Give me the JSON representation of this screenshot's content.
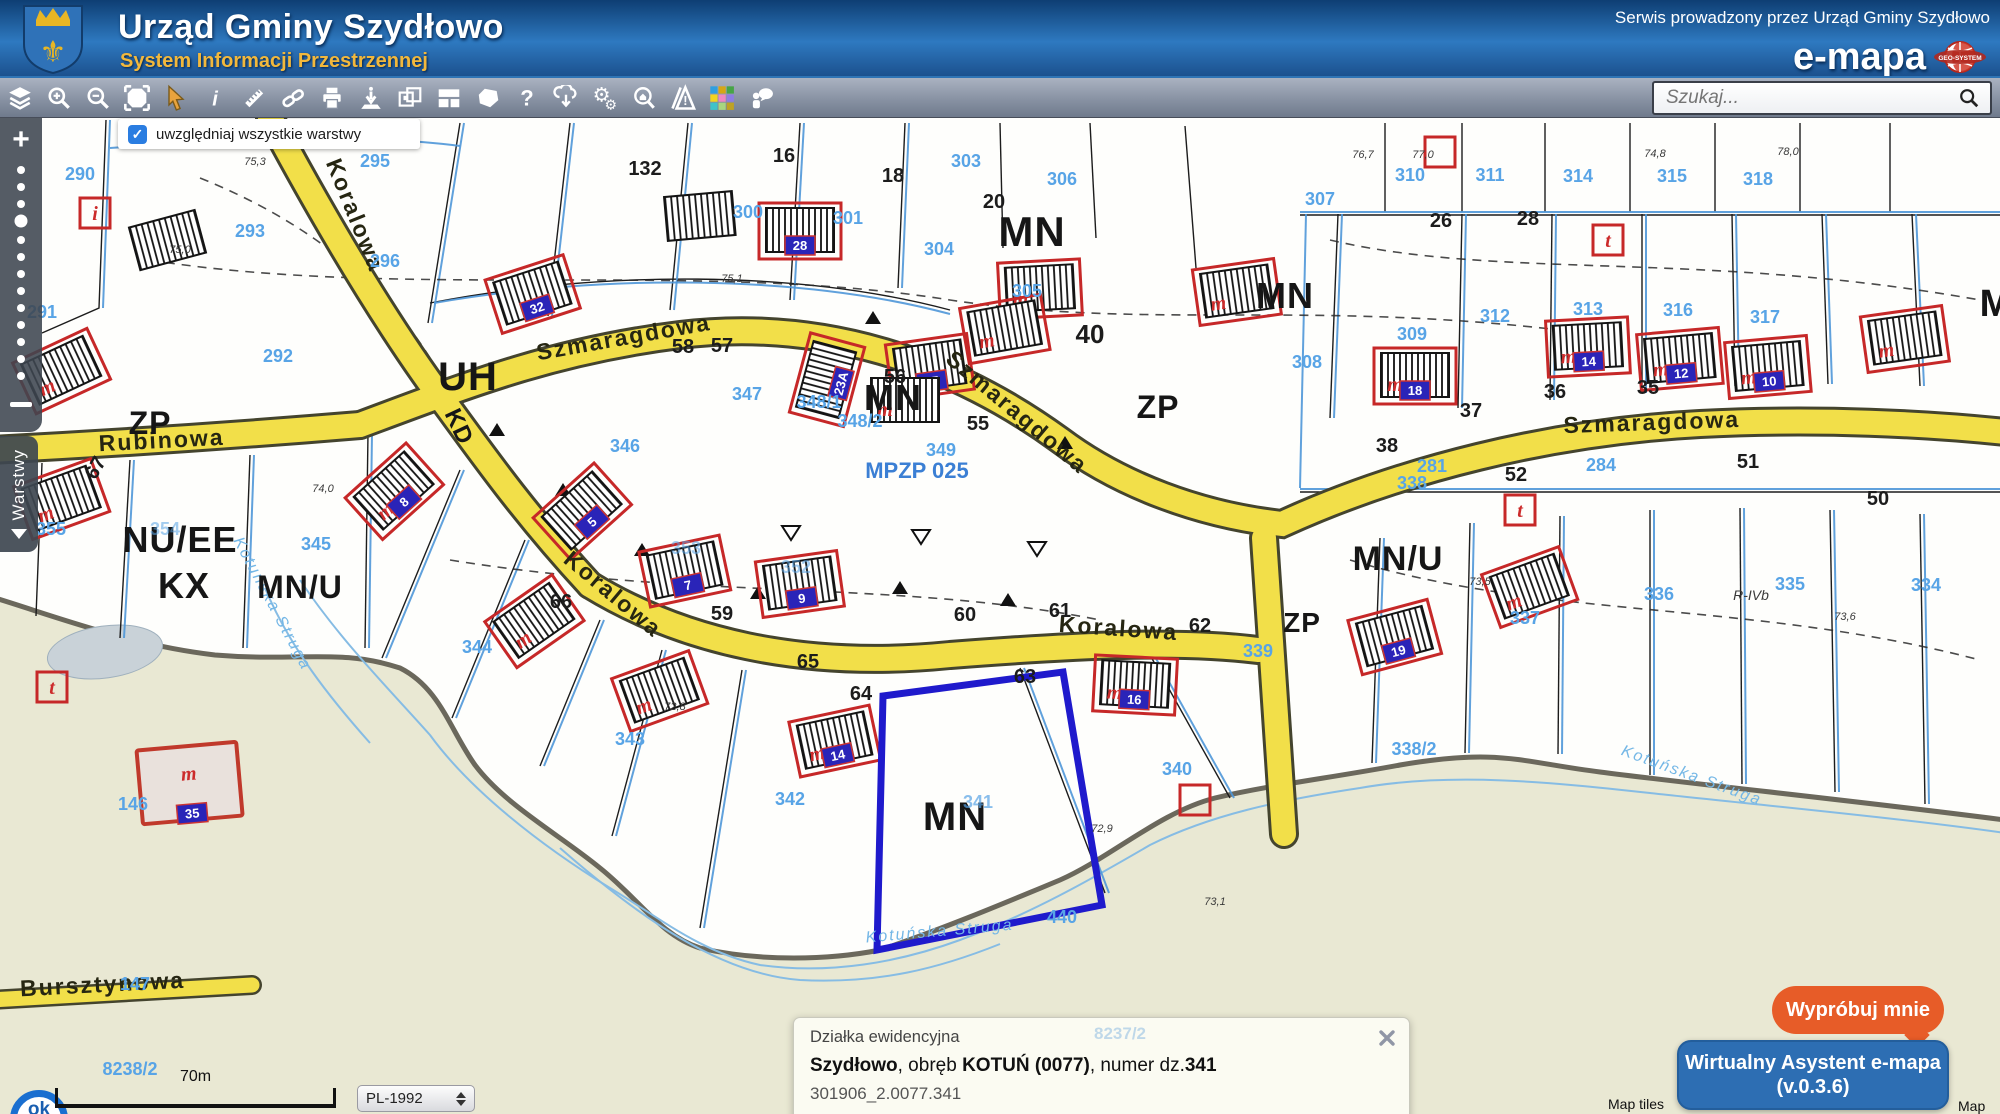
{
  "header": {
    "title": "Urząd Gminy Szydłowo",
    "subtitle": "System Informacji Przestrzennej",
    "service_note": "Serwis prowadzony przez Urząd Gminy Szydłowo",
    "brand": "e-mapa",
    "brand_logo_text": "GEO-SYSTEM"
  },
  "toolbar": {
    "search_placeholder": "Szukaj...",
    "tools": [
      "layers",
      "zoom-in",
      "zoom-out",
      "full-extent",
      "pointer",
      "info",
      "measure",
      "link",
      "print",
      "locate",
      "compare",
      "layout",
      "polygon",
      "help",
      "download",
      "settings",
      "search-address",
      "warnings",
      "basemaps",
      "feedback"
    ]
  },
  "map_controls": {
    "layers_checkbox_label": "uwzględniaj wszystkie warstwy",
    "checkbox_checked": "✓",
    "zoom_in": "+",
    "layers_tab": "Warstwy"
  },
  "bottom_bar": {
    "scale": "70m",
    "crs": "PL-1992",
    "logo": "ok",
    "attribution_left": "Map tiles",
    "attribution_right": "Map"
  },
  "info_panel": {
    "title": "Działka ewidencyjna",
    "ghost": "8237/2",
    "b1": "Szydłowo",
    "t1": ", obręb ",
    "b2": "KOTUŃ (0077)",
    "t2": ", numer dz.",
    "b3": "341",
    "parcel_id": "301906_2.0077.341",
    "link1": "Zbliż do obiektu",
    "link2": "Szczegóły (I)",
    "geo_icon": "i",
    "link3": "Informacja o lokalizacji"
  },
  "assistant": {
    "try_label": "Wypróbuj mnie",
    "name": "Wirtualny Asystent e-mapa",
    "version": "(v.0.3.6)"
  },
  "map": {
    "selected_parcel": "341",
    "accent_colors": {
      "road": "#f2df49",
      "parcel_line": "#4f97d8",
      "selected": "#1f1acc",
      "building": "#c62828",
      "label": "#58a4e6"
    },
    "labels": [
      {
        "t": "Szmaragdowa",
        "k": "street",
        "x": 625,
        "y": 227,
        "r": -10
      },
      {
        "t": "Szmaragdowa",
        "k": "street",
        "x": 1012,
        "y": 300,
        "r": 40
      },
      {
        "t": "Szmaragdowa",
        "k": "street",
        "x": 1652,
        "y": 312,
        "r": -2
      },
      {
        "t": "Rubinowa",
        "k": "street",
        "x": 162,
        "y": 330,
        "r": -3
      },
      {
        "t": "Koralowa",
        "k": "street",
        "x": 348,
        "y": 100,
        "r": 68
      },
      {
        "t": "Koralowa",
        "k": "street",
        "x": 608,
        "y": 482,
        "r": 40
      },
      {
        "t": "Koralowa",
        "k": "street",
        "x": 1118,
        "y": 518,
        "r": 4
      },
      {
        "t": "Bursztynowa",
        "k": "street",
        "x": 103,
        "y": 874,
        "r": -3
      },
      {
        "t": "Kotuńska Struga",
        "k": "stream",
        "x": 268,
        "y": 488,
        "r": 62
      },
      {
        "t": "Kotuńska Struga",
        "k": "stream",
        "x": 940,
        "y": 818,
        "r": -5
      },
      {
        "t": "Kotuńska Struga",
        "k": "stream",
        "x": 1690,
        "y": 662,
        "r": 20
      },
      {
        "t": "MPZP 025",
        "k": "plan",
        "x": 917,
        "y": 360
      },
      {
        "t": "MN",
        "k": "zone",
        "x": 1032,
        "y": 128,
        "s": 42
      },
      {
        "t": "MN",
        "k": "zone",
        "x": 893,
        "y": 292,
        "s": 36
      },
      {
        "t": "MN",
        "k": "zone",
        "x": 955,
        "y": 712,
        "s": 40
      },
      {
        "t": "MN",
        "k": "zone",
        "x": 1285,
        "y": 190,
        "s": 36
      },
      {
        "t": "M",
        "k": "zone",
        "x": 1996,
        "y": 198,
        "s": 38
      },
      {
        "t": "MN/U",
        "k": "zone",
        "x": 300,
        "y": 480,
        "s": 32
      },
      {
        "t": "MN/U",
        "k": "zone",
        "x": 1398,
        "y": 452,
        "s": 34
      },
      {
        "t": "ZP",
        "k": "zone",
        "x": 150,
        "y": 316,
        "s": 32
      },
      {
        "t": "ZP",
        "k": "zone",
        "x": 1158,
        "y": 300,
        "s": 32
      },
      {
        "t": "ZP",
        "k": "zone",
        "x": 1302,
        "y": 514,
        "s": 28
      },
      {
        "t": "NU/EE",
        "k": "zone",
        "x": 180,
        "y": 434,
        "s": 36
      },
      {
        "t": "KX",
        "k": "zone",
        "x": 184,
        "y": 480,
        "s": 36
      },
      {
        "t": "UH",
        "k": "zone",
        "x": 468,
        "y": 272,
        "s": 40
      },
      {
        "t": "KD",
        "k": "zone",
        "x": 452,
        "y": 312,
        "s": 24,
        "r": 65
      },
      {
        "t": "290",
        "k": "pn",
        "x": 80,
        "y": 62
      },
      {
        "t": "291",
        "k": "pn",
        "x": 42,
        "y": 200
      },
      {
        "t": "292",
        "k": "pn",
        "x": 278,
        "y": 244
      },
      {
        "t": "293",
        "k": "pn",
        "x": 250,
        "y": 119
      },
      {
        "t": "295",
        "k": "pn",
        "x": 375,
        "y": 49
      },
      {
        "t": "296",
        "k": "pn",
        "x": 385,
        "y": 149
      },
      {
        "t": "300",
        "k": "pn",
        "x": 748,
        "y": 100
      },
      {
        "t": "301",
        "k": "pn",
        "x": 848,
        "y": 106
      },
      {
        "t": "303",
        "k": "pn",
        "x": 966,
        "y": 49
      },
      {
        "t": "304",
        "k": "pn",
        "x": 939,
        "y": 137
      },
      {
        "t": "305",
        "k": "pn",
        "x": 1027,
        "y": 179
      },
      {
        "t": "306",
        "k": "pn",
        "x": 1062,
        "y": 67
      },
      {
        "t": "307",
        "k": "pn",
        "x": 1320,
        "y": 87
      },
      {
        "t": "308",
        "k": "pn",
        "x": 1307,
        "y": 250
      },
      {
        "t": "309",
        "k": "pn",
        "x": 1412,
        "y": 222
      },
      {
        "t": "310",
        "k": "pn",
        "x": 1410,
        "y": 63
      },
      {
        "t": "311",
        "k": "pn",
        "x": 1490,
        "y": 63
      },
      {
        "t": "312",
        "k": "pn",
        "x": 1495,
        "y": 204
      },
      {
        "t": "313",
        "k": "pn",
        "x": 1588,
        "y": 197
      },
      {
        "t": "314",
        "k": "pn",
        "x": 1578,
        "y": 64
      },
      {
        "t": "315",
        "k": "pn",
        "x": 1672,
        "y": 64
      },
      {
        "t": "316",
        "k": "pn",
        "x": 1678,
        "y": 198
      },
      {
        "t": "317",
        "k": "pn",
        "x": 1765,
        "y": 205
      },
      {
        "t": "318",
        "k": "pn",
        "x": 1758,
        "y": 67
      },
      {
        "t": "281",
        "k": "pn",
        "x": 1432,
        "y": 354
      },
      {
        "t": "284",
        "k": "pn",
        "x": 1601,
        "y": 353
      },
      {
        "t": "355",
        "k": "pn",
        "x": 51,
        "y": 417
      },
      {
        "t": "354",
        "k": "pn",
        "x": 165,
        "y": 417,
        "o": 0.55
      },
      {
        "t": "345",
        "k": "pn",
        "x": 316,
        "y": 432
      },
      {
        "t": "344",
        "k": "pn",
        "x": 477,
        "y": 535
      },
      {
        "t": "346",
        "k": "pn",
        "x": 625,
        "y": 334
      },
      {
        "t": "347",
        "k": "pn",
        "x": 747,
        "y": 282
      },
      {
        "t": "348/1",
        "k": "pn",
        "x": 819,
        "y": 290
      },
      {
        "t": "348/2",
        "k": "pn",
        "x": 860,
        "y": 309
      },
      {
        "t": "349",
        "k": "pn",
        "x": 941,
        "y": 338
      },
      {
        "t": "353",
        "k": "pn",
        "x": 686,
        "y": 436,
        "o": 0.55
      },
      {
        "t": "352",
        "k": "pn",
        "x": 796,
        "y": 455,
        "o": 0.55
      },
      {
        "t": "339",
        "k": "pn",
        "x": 1258,
        "y": 539
      },
      {
        "t": "340",
        "k": "pn",
        "x": 1177,
        "y": 657
      },
      {
        "t": "341",
        "k": "pn",
        "x": 978,
        "y": 690,
        "o": 0.7
      },
      {
        "t": "342",
        "k": "pn",
        "x": 790,
        "y": 687
      },
      {
        "t": "343",
        "k": "pn",
        "x": 630,
        "y": 627
      },
      {
        "t": "440",
        "k": "pn",
        "x": 1062,
        "y": 805
      },
      {
        "t": "338/2",
        "k": "pn",
        "x": 1414,
        "y": 637
      },
      {
        "t": "338",
        "k": "pn",
        "x": 1412,
        "y": 371
      },
      {
        "t": "337",
        "k": "pn",
        "x": 1525,
        "y": 506
      },
      {
        "t": "336",
        "k": "pn",
        "x": 1659,
        "y": 482
      },
      {
        "t": "335",
        "k": "pn",
        "x": 1790,
        "y": 472
      },
      {
        "t": "334",
        "k": "pn",
        "x": 1926,
        "y": 473
      },
      {
        "t": "146",
        "k": "pn",
        "x": 133,
        "y": 692
      },
      {
        "t": "147",
        "k": "pn",
        "x": 135,
        "y": 872
      },
      {
        "t": "8238/2",
        "k": "pn",
        "x": 130,
        "y": 957
      },
      {
        "t": "58",
        "k": "num",
        "x": 683,
        "y": 235
      },
      {
        "t": "57",
        "k": "num",
        "x": 722,
        "y": 234
      },
      {
        "t": "59",
        "k": "num",
        "x": 722,
        "y": 502
      },
      {
        "t": "60",
        "k": "num",
        "x": 965,
        "y": 503
      },
      {
        "t": "61",
        "k": "num",
        "x": 1060,
        "y": 499
      },
      {
        "t": "62",
        "k": "num",
        "x": 1200,
        "y": 514
      },
      {
        "t": "63",
        "k": "num",
        "x": 1025,
        "y": 565
      },
      {
        "t": "64",
        "k": "num",
        "x": 861,
        "y": 582
      },
      {
        "t": "65",
        "k": "num",
        "x": 808,
        "y": 550
      },
      {
        "t": "66",
        "k": "num",
        "x": 561,
        "y": 490
      },
      {
        "t": "67",
        "k": "num",
        "x": 101,
        "y": 353,
        "r": -60
      },
      {
        "t": "36",
        "k": "num",
        "x": 1555,
        "y": 280
      },
      {
        "t": "37",
        "k": "num",
        "x": 1471,
        "y": 299
      },
      {
        "t": "38",
        "k": "num",
        "x": 1387,
        "y": 334
      },
      {
        "t": "35",
        "k": "num",
        "x": 1648,
        "y": 276
      },
      {
        "t": "51",
        "k": "num",
        "x": 1748,
        "y": 350
      },
      {
        "t": "52",
        "k": "num",
        "x": 1516,
        "y": 363
      },
      {
        "t": "50",
        "k": "num",
        "x": 1878,
        "y": 387
      },
      {
        "t": "26",
        "k": "num",
        "x": 1441,
        "y": 109
      },
      {
        "t": "28",
        "k": "num",
        "x": 1528,
        "y": 107
      },
      {
        "t": "20",
        "k": "num",
        "x": 994,
        "y": 90
      },
      {
        "t": "18",
        "k": "num",
        "x": 893,
        "y": 64
      },
      {
        "t": "16",
        "k": "num",
        "x": 784,
        "y": 44
      },
      {
        "t": "132",
        "k": "num",
        "x": 645,
        "y": 57
      },
      {
        "t": "56",
        "k": "num",
        "x": 895,
        "y": 265
      },
      {
        "t": "55",
        "k": "num",
        "x": 978,
        "y": 312
      },
      {
        "t": "40",
        "k": "num",
        "x": 1090,
        "y": 225,
        "s": 26
      },
      {
        "t": "75,1",
        "k": "elev",
        "x": 732,
        "y": 164
      },
      {
        "t": "74,0",
        "k": "elev",
        "x": 323,
        "y": 374
      },
      {
        "t": "72,9",
        "k": "elev",
        "x": 1102,
        "y": 714
      },
      {
        "t": "73,1",
        "k": "elev",
        "x": 1215,
        "y": 787
      },
      {
        "t": "72,8",
        "k": "elev",
        "x": 675,
        "y": 592
      },
      {
        "t": "76,7",
        "k": "elev",
        "x": 1363,
        "y": 40
      },
      {
        "t": "77,0",
        "k": "elev",
        "x": 1423,
        "y": 40
      },
      {
        "t": "74,8",
        "k": "elev",
        "x": 1655,
        "y": 39
      },
      {
        "t": "78,0",
        "k": "elev",
        "x": 1788,
        "y": 37
      },
      {
        "t": "75,3",
        "k": "elev",
        "x": 255,
        "y": 47
      },
      {
        "t": "75,0",
        "k": "elev",
        "x": 180,
        "y": 135
      },
      {
        "t": "73,5",
        "k": "elev",
        "x": 1480,
        "y": 467
      },
      {
        "t": "73,6",
        "k": "elev",
        "x": 1845,
        "y": 502
      },
      {
        "t": "R-IVb",
        "k": "elev",
        "x": 1751,
        "y": 482,
        "s": 14
      }
    ],
    "buildings": [
      {
        "x": 533,
        "y": 177,
        "r": -18,
        "p": "32"
      },
      {
        "x": 800,
        "y": 114,
        "r": 0,
        "p": "28"
      },
      {
        "x": 1040,
        "y": 172,
        "r": -3,
        "m": true
      },
      {
        "x": 930,
        "y": 250,
        "r": -8,
        "p": "25"
      },
      {
        "x": 828,
        "y": 262,
        "r": -75,
        "p": "23A"
      },
      {
        "x": 905,
        "y": 284,
        "r": 0,
        "k": "plain",
        "m": true
      },
      {
        "x": 1005,
        "y": 212,
        "r": -10,
        "m": true
      },
      {
        "x": 1237,
        "y": 175,
        "r": -8,
        "m": true
      },
      {
        "x": 1415,
        "y": 259,
        "r": 0,
        "p": "18",
        "m": true
      },
      {
        "x": 1588,
        "y": 230,
        "r": -3,
        "p": "14",
        "m": true
      },
      {
        "x": 1680,
        "y": 242,
        "r": -5,
        "p": "12",
        "m": true
      },
      {
        "x": 1768,
        "y": 250,
        "r": -5,
        "p": "10",
        "m": true
      },
      {
        "x": 1905,
        "y": 222,
        "r": -8,
        "m": true
      },
      {
        "x": 395,
        "y": 374,
        "r": -42,
        "p": "8",
        "m": true
      },
      {
        "x": 583,
        "y": 394,
        "r": -42,
        "p": "5"
      },
      {
        "x": 685,
        "y": 454,
        "r": -12,
        "p": "7"
      },
      {
        "x": 535,
        "y": 504,
        "r": -35,
        "m": true
      },
      {
        "x": 800,
        "y": 467,
        "r": -8,
        "p": "9"
      },
      {
        "x": 835,
        "y": 624,
        "r": -12,
        "p": "14",
        "m": true
      },
      {
        "x": 660,
        "y": 574,
        "r": -20,
        "m": true
      },
      {
        "x": 1135,
        "y": 568,
        "r": 3,
        "p": "16",
        "m": true
      },
      {
        "x": 1395,
        "y": 520,
        "r": -15,
        "p": "19"
      },
      {
        "x": 1530,
        "y": 470,
        "r": -20,
        "m": true
      },
      {
        "x": 190,
        "y": 670,
        "r": -5,
        "p": "35",
        "m": true,
        "k": "big"
      },
      {
        "x": 62,
        "y": 382,
        "r": -20,
        "m": true
      },
      {
        "x": 62,
        "y": 254,
        "r": -25,
        "m": true
      },
      {
        "x": 168,
        "y": 124,
        "r": -15,
        "k": "plain"
      },
      {
        "x": 700,
        "y": 100,
        "r": -5,
        "k": "plain"
      }
    ],
    "marks": [
      {
        "x": 1608,
        "y": 122,
        "t": "t"
      },
      {
        "x": 1520,
        "y": 392,
        "t": "t"
      },
      {
        "x": 52,
        "y": 569,
        "t": "t"
      },
      {
        "x": 95,
        "y": 95,
        "t": "i"
      },
      {
        "x": 1440,
        "y": 34,
        "t": ""
      },
      {
        "x": 1195,
        "y": 682,
        "t": ""
      }
    ]
  }
}
